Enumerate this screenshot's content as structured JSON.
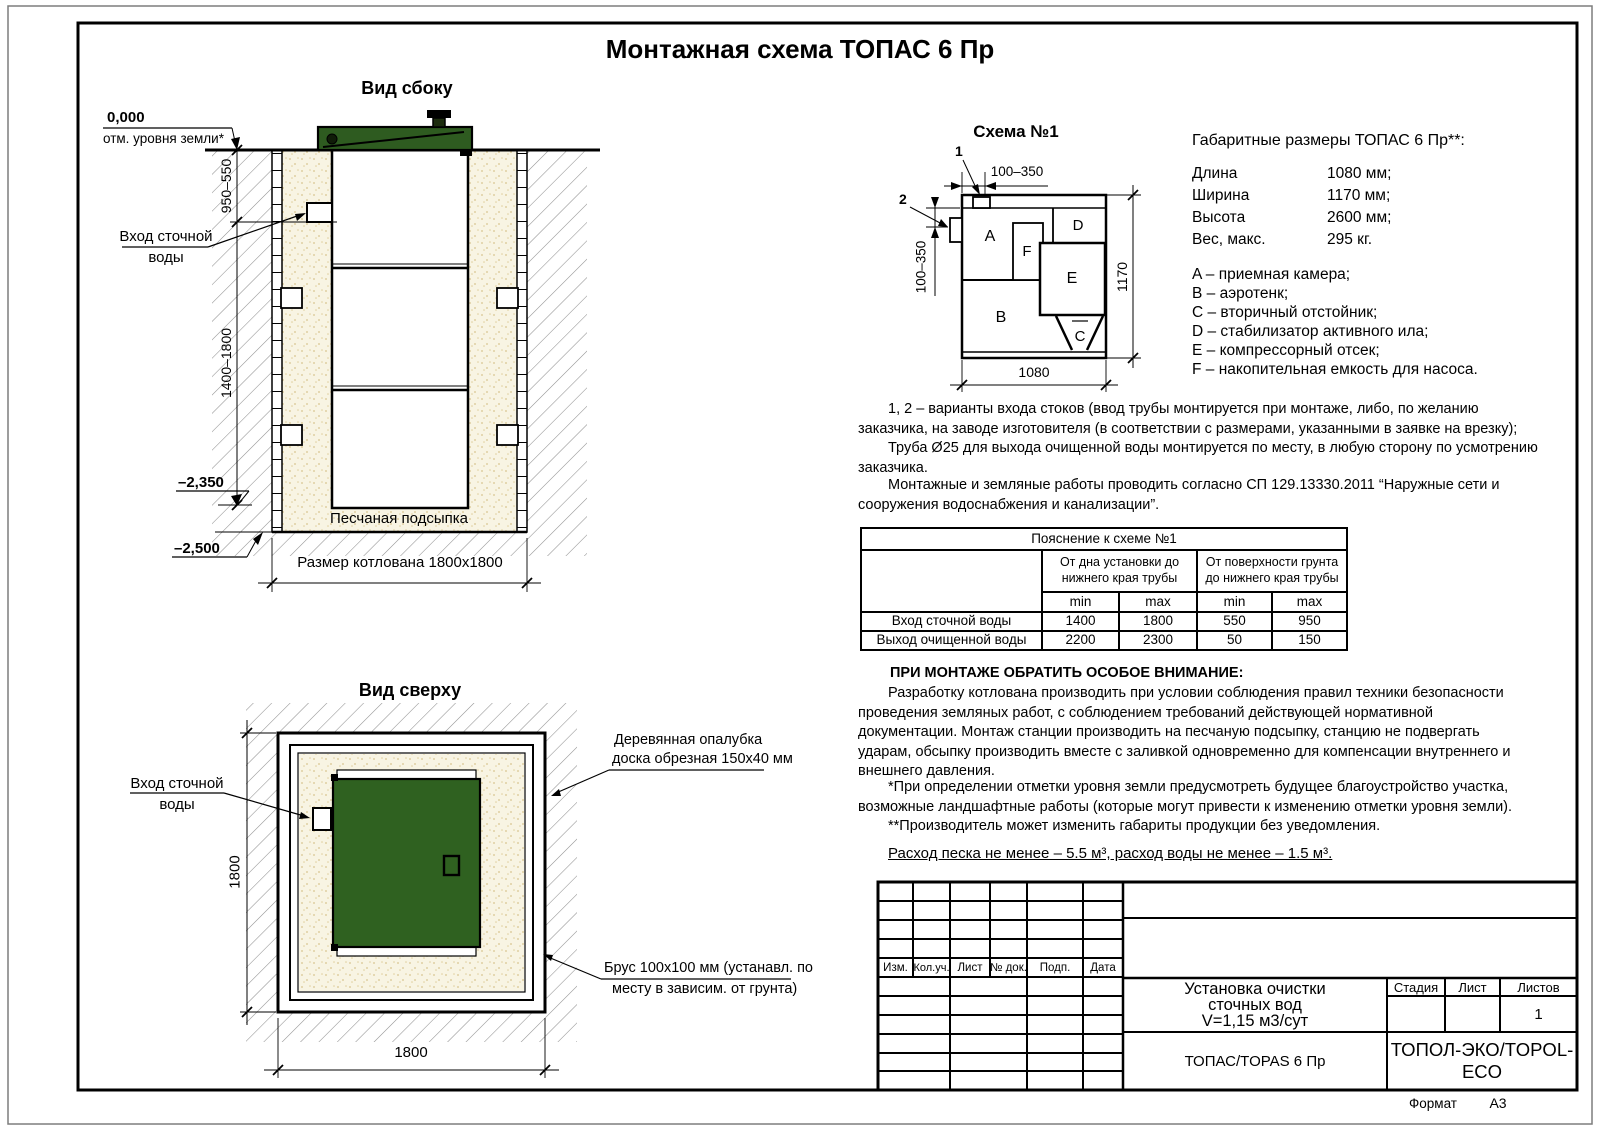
{
  "page": {
    "title": "Монтажная схема ТОПАС 6 Пр",
    "format_label": "Формат",
    "format_value": "А3"
  },
  "colors": {
    "lid_green_side": "#2e5b20",
    "lid_green_top": "#2f6120",
    "sand": "#f8f4e3",
    "sand_speck": "#d8c48f",
    "hatch_line": "#909090"
  },
  "side_view": {
    "title": "Вид сбоку",
    "level_zero": "0,000",
    "level_zero_label": "отм. уровня земли*",
    "dim_depth_upper": "950–550",
    "dim_depth_lower": "1400–1800",
    "inlet_label_line1": "Вход сточной",
    "inlet_label_line2": "воды",
    "level_minus_2350": "–2,350",
    "level_minus_2500": "–2,500",
    "sand_label": "Песчаная подсыпка",
    "pit_dim": "Размер котлована 1800x1800"
  },
  "top_view": {
    "title": "Вид сверху",
    "inlet_label_line1": "Вход сточной",
    "inlet_label_line2": "воды",
    "dim_left": "1800",
    "dim_bottom": "1800",
    "formwork_label_line1": "Деревянная опалубка",
    "formwork_label_line2": "доска обрезная 150x40 мм",
    "beam_label_line1": "Брус 100x100 мм (устанавл. по",
    "beam_label_line2": "месту в зависим. от грунта)"
  },
  "schema": {
    "title": "Схема №1",
    "callout_1": "1",
    "callout_2": "2",
    "dim_top": "100–350",
    "dim_left": "100–350",
    "dim_right": "1170",
    "dim_bottom": "1080",
    "comp": {
      "a": "A",
      "b": "B",
      "c": "C",
      "d": "D",
      "e": "E",
      "f": "F"
    }
  },
  "specs": {
    "title": "Габаритные размеры ТОПАС 6 Пр**:",
    "rows": [
      {
        "label": "Длина",
        "value": "1080 мм;"
      },
      {
        "label": "Ширина",
        "value": "1170 мм;"
      },
      {
        "label": "Высота",
        "value": "2600 мм;"
      },
      {
        "label": "Вес, макс.",
        "value": "295 кг."
      }
    ],
    "legend": [
      "A – приемная камера;",
      "B – аэротенк;",
      "C – вторичный отстойник;",
      "D – стабилизатор активного ила;",
      "E – компрессорный отсек;",
      "F – накопительная емкость для насоса."
    ]
  },
  "notes": {
    "note1a": "1, 2 – варианты входа  стоков (ввод трубы монтируется при монтаже, либо, по желанию заказчика, на заводе изготовителя (в соответствии с размерами, указанными в заявке на врезку);",
    "note1b": "Труба Ø25 для выхода очищенной воды монтируется по месту, в любую сторону по усмотрению заказчика.",
    "note2": "Монтажные и земляные работы проводить согласно СП 129.13330.2011 “Наружные сети и сооружения водоснабжения и канализации”.",
    "attention_title": "ПРИ МОНТАЖЕ ОБРАТИТЬ ОСОБОЕ ВНИМАНИЕ:",
    "attention_body": "Разработку котлована производить при условии соблюдения правил техники безопасности проведения земляных работ, с соблюдением требований действующей нормативной документации. Монтаж станции производить на песчаную подсыпку, станцию не подвергать ударам, обсыпку производить вместе с заливкой одновременно для компенсации внутреннего и внешнего давления.",
    "footnote1": "*При определении отметки уровня земли предусмотреть будущее благоустройство участка, возможные ландшафтные работы (которые могут привести к изменению отметки уровня земли).",
    "footnote2": "**Производитель может изменить габариты продукции без уведомления.",
    "consumption": "Расход песка не менее – 5.5 м³, расход воды не менее – 1.5 м³."
  },
  "pipe_table": {
    "title": "Пояснение к схеме №1",
    "group1": "От дна установки до нижнего края трубы",
    "group2": "От поверхности грунта до нижнего края трубы",
    "min1": "min",
    "max1": "max",
    "min2": "min",
    "max2": "max",
    "rows": [
      {
        "label": "Вход сточной воды",
        "values": [
          "1400",
          "1800",
          "550",
          "950"
        ]
      },
      {
        "label": "Выход очищенной воды",
        "values": [
          "2200",
          "2300",
          "50",
          "150"
        ]
      }
    ]
  },
  "title_block": {
    "header_cols": [
      "Изм.",
      "Кол.уч.",
      "Лист",
      "№ док.",
      "Подп.",
      "Дата"
    ],
    "doc_name_line1": "Установка очистки",
    "doc_name_line2": "сточных вод",
    "doc_name_line3": "V=1,15 м3/сут",
    "stage_label": "Стадия",
    "sheet_label": "Лист",
    "sheets_label": "Листов",
    "sheets_value": "1",
    "product": "ТОПАС/TOPAS 6 Пр",
    "company": "ТОПОЛ-ЭКО/TOPOL-ECO"
  }
}
